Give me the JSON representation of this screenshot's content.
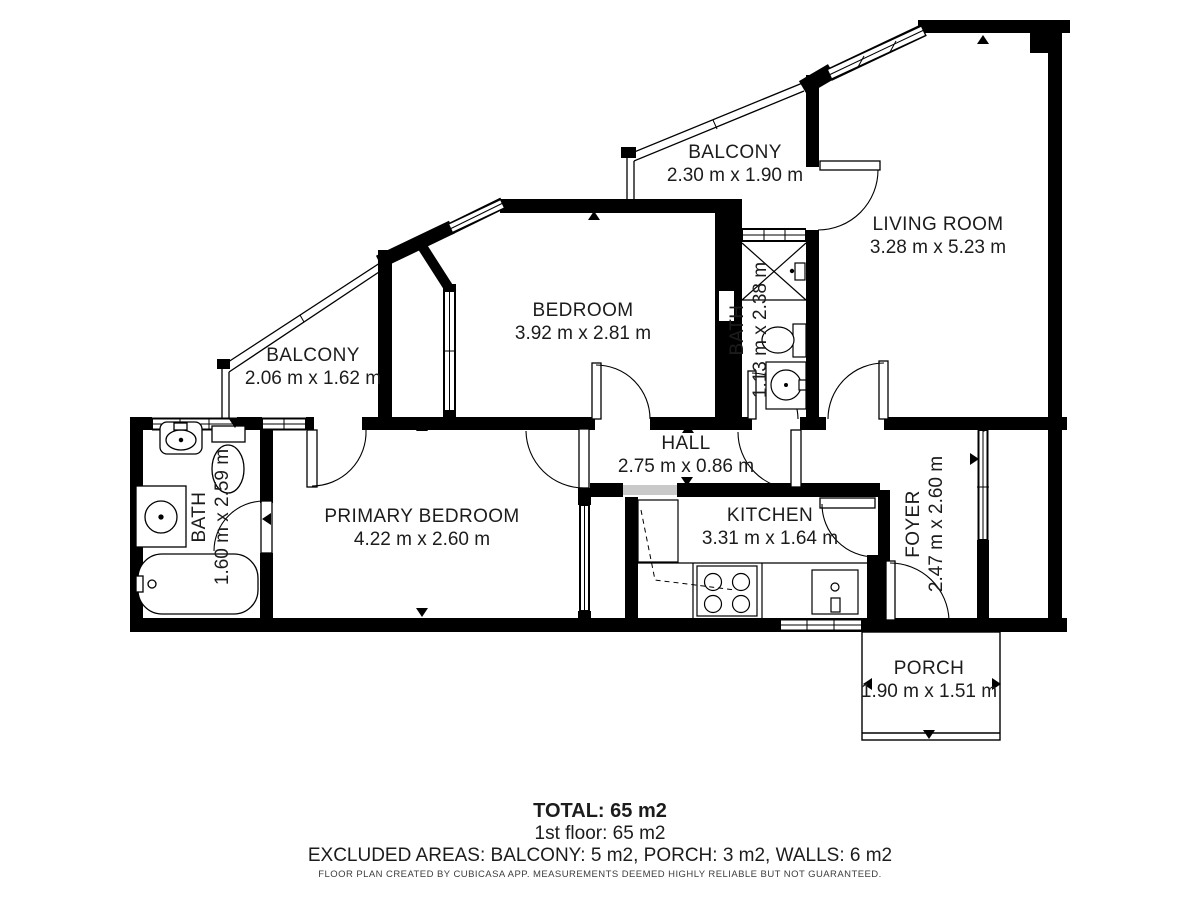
{
  "rooms": [
    {
      "name": "BALCONY",
      "dims": "2.30 m x 1.90 m"
    },
    {
      "name": "LIVING ROOM",
      "dims": "3.28 m x 5.23 m"
    },
    {
      "name": "BEDROOM",
      "dims": "3.92 m x 2.81 m"
    },
    {
      "name": "BALCONY",
      "dims": "2.06 m x 1.62 m"
    },
    {
      "name": "BATH",
      "dims": "1.13 m x 2.38 m"
    },
    {
      "name": "HALL",
      "dims": "2.75 m x 0.86 m"
    },
    {
      "name": "PRIMARY BEDROOM",
      "dims": "4.22 m x 2.60 m"
    },
    {
      "name": "BATH",
      "dims": "1.60 m x 2.59 m"
    },
    {
      "name": "KITCHEN",
      "dims": "3.31 m x 1.64 m"
    },
    {
      "name": "FOYER",
      "dims": "2.47 m x 2.60 m"
    },
    {
      "name": "PORCH",
      "dims": "1.90 m x 1.51 m"
    }
  ],
  "summary": {
    "total": "TOTAL: 65 m2",
    "floor": "1st floor: 65 m2",
    "excluded": "EXCLUDED AREAS: BALCONY: 5 m2, PORCH: 3 m2, WALLS: 6 m2",
    "footer": "FLOOR PLAN CREATED BY CUBICASA APP. MEASUREMENTS DEEMED HIGHLY RELIABLE BUT NOT GUARANTEED."
  },
  "colors": {
    "wall": "#000000",
    "background": "#ffffff",
    "text": "#1c1c1c"
  }
}
